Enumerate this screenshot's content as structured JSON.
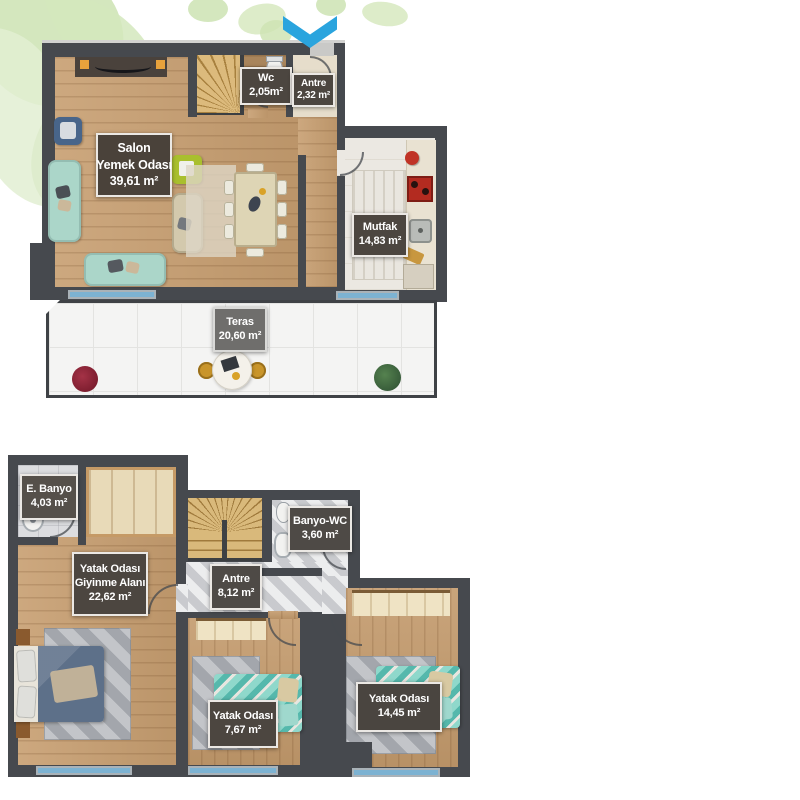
{
  "meta": {
    "type": "apartment-floor-plan",
    "floor_count": 2,
    "language": "tr"
  },
  "upper_floor": {
    "salon": {
      "name1": "Salon",
      "name2": "Yemek Odası",
      "area": "39,61 m²"
    },
    "wc": {
      "name1": "Wc",
      "area": "2,05m²"
    },
    "antre": {
      "name1": "Antre",
      "area": "2,32 m²"
    },
    "mutfak": {
      "name1": "Mutfak",
      "area": "14,83 m²"
    },
    "teras": {
      "name1": "Teras",
      "area": "20,60 m²"
    }
  },
  "lower_floor": {
    "ebanyo": {
      "name1": "E. Banyo",
      "area": "4,03 m²"
    },
    "master": {
      "name1": "Yatak Odası",
      "name2": "Giyinme Alanı",
      "area": "22,62 m²"
    },
    "banyowc": {
      "name1": "Banyo-WC",
      "area": "3,60 m²"
    },
    "antre": {
      "name1": "Antre",
      "area": "8,12 m²"
    },
    "bedroom2": {
      "name1": "Yatak Odası",
      "area": "7,67 m²"
    },
    "bedroom3": {
      "name1": "Yatak Odası",
      "area": "14,45 m²"
    }
  },
  "icons": {
    "entrance_arrow": "chevron-down"
  },
  "colors": {
    "wall": "#46494e",
    "label_bg": "#4c4640",
    "teras_label_bg": "#6f6e6c",
    "label_border": "#ebe8e4",
    "arrow": "#2aa4de",
    "window": "#7cb2d2",
    "wood": "#c79e70",
    "marble": "#d6d7d9",
    "leaf": "#cde3b3",
    "sofa": "#abd6c9",
    "bed": "#7ecfc4",
    "blanket": "#5d7089"
  }
}
